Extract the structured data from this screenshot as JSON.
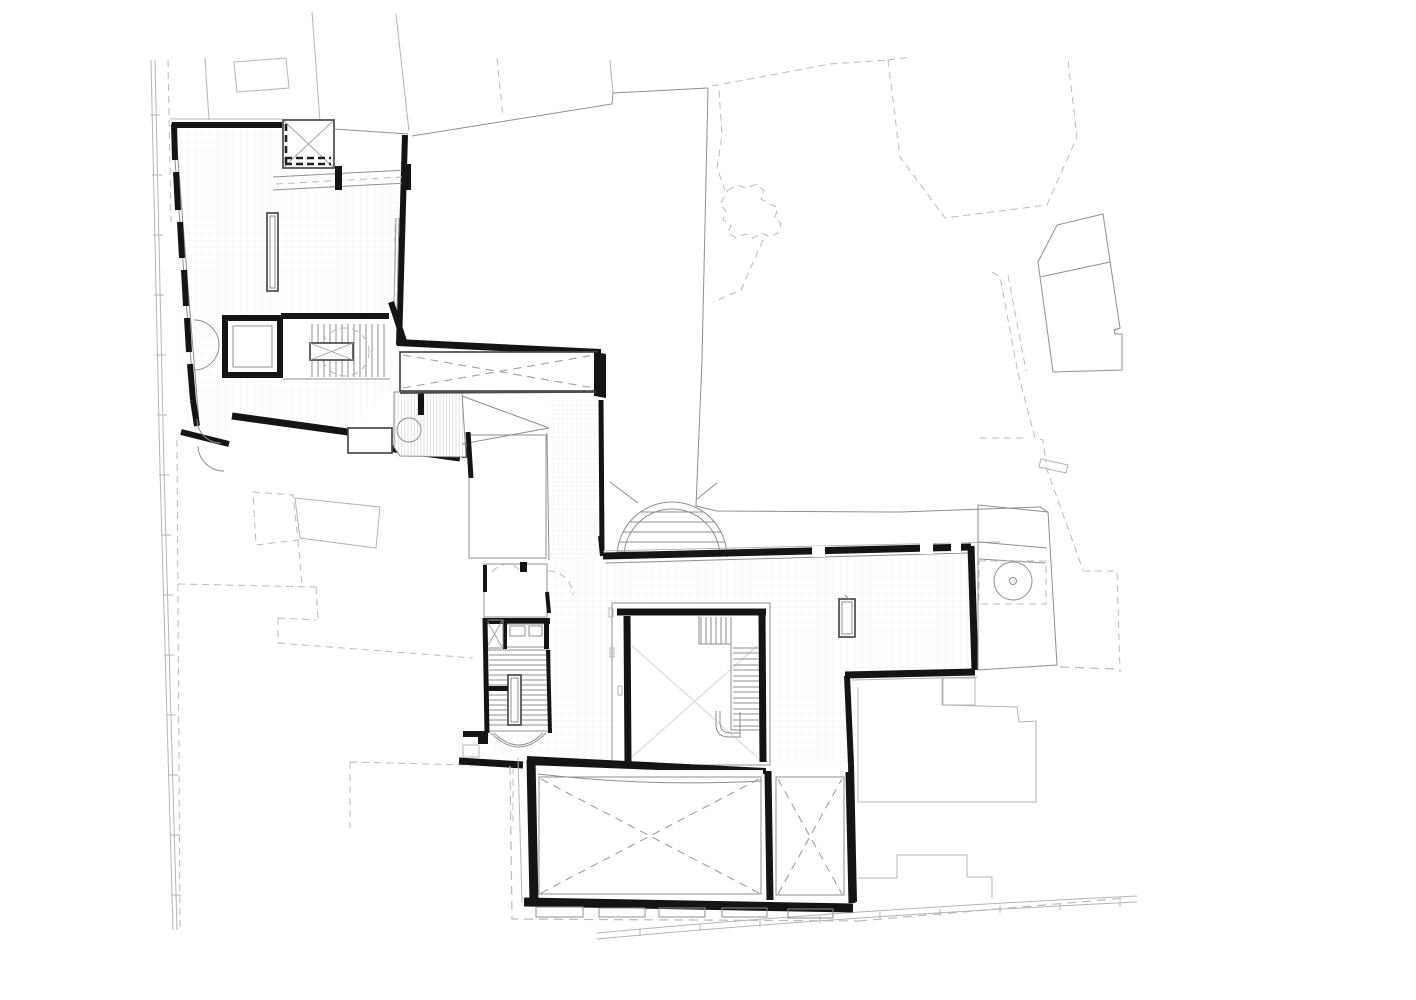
{
  "page": {
    "kind": "architectural-floor-plan",
    "background": "#ffffff"
  },
  "colors": {
    "wall": "#141414",
    "medium": "#4a4a4a",
    "thin": "#8f8f8f",
    "light": "#b5b5b5",
    "dashed": "#bcbcbc",
    "xmark": "#a0a0a0",
    "xfaint": "#d4d4d4",
    "grid": "#e7e7e7",
    "hatch": "#d8d8d8",
    "paper": "#ffffff",
    "darkdash": "#1f1f1f"
  },
  "labels": {
    "drawing": "floor-plan-drawing",
    "site_context": "site-context-lines",
    "street_edge_west": "street-edge-west",
    "road_curve_south": "road-curve-south",
    "neighbor_outline_top": "adjacent-building-outline",
    "neighbor_dashed_ne": "dashed-neighbor-footprint",
    "neighbor_building_east": "neighbor-building-east",
    "tower_footprint": "notched-tower-footprint",
    "site_boundary_sw": "dashed-site-boundary-southwest",
    "site_boundary_se": "dashed-site-boundary-southeast",
    "north_wing": "north-wing-gallery",
    "skylight_void": "skylight-x-void",
    "glazed_link": "glazed-roof-band",
    "display_case": "display-case",
    "elevator_core": "elevator-core",
    "wing_stair": "wing-stair",
    "annex_room": "annex-room",
    "ramp_room": "hatched-ramp-room",
    "bridge_void": "bridge-x-void",
    "corridor": "central-corridor",
    "service_core": "service-core",
    "switchback_stair": "switchback-stair",
    "entry_arch_stair": "semicircular-entry-stair",
    "great_hall": "great-hall",
    "atrium_void": "atrium-void-with-l-stair",
    "east_terrace": "east-terrace",
    "round_table": "round-table",
    "south_block": "south-block-voids",
    "buttresses": "buttress-row"
  }
}
